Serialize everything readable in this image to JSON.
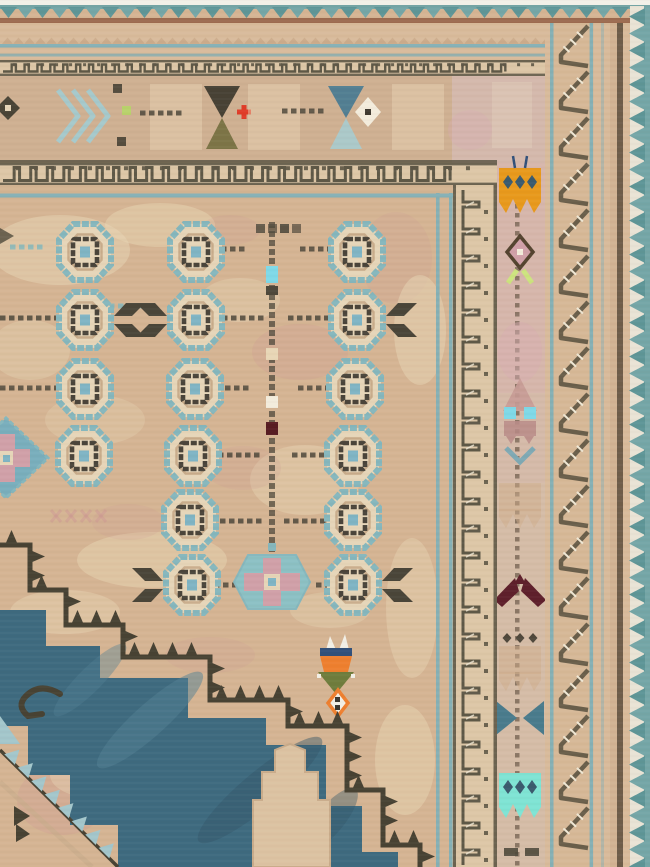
{
  "subject": "corner detail photograph of a vintage hand-knotted tribal rug",
  "palette": {
    "white_edge": "#f2f0e8",
    "teal_zig": "#74a6a7",
    "teal_zig_dark": "#5e9597",
    "red_line": "#9c6a4f",
    "outer_tan": "#d8bb9b",
    "outer_tan2": "#d2b393",
    "blue_line": "#85b0b5",
    "meander_bg": "#ddc7a7",
    "meander_dark": "#5e5847",
    "border_tan": "#cfb092",
    "corner_pink": "#d4b9ac",
    "field_tan": "#d5b493",
    "field_light": "#e8d6b6",
    "field_pink": "#cf9b94",
    "gul_blue": "#85b7bd",
    "gul_cream": "#e6d5b8",
    "gul_tan": "#c2a483",
    "gul_dark": "#4a443a",
    "gul_center": "#7fb4c4",
    "dash_dark": "#4e483b",
    "wing_dark": "#4a4539",
    "med_blue": "#3e6a7f",
    "med_blue_lt": "#517f93",
    "med_blue_dk": "#33576a",
    "med_dark": "#474233",
    "med_srr_blue": "#a3c6cb",
    "hex_blue": "#8cc0c4",
    "hex_pink": "#d0a0a8",
    "dia_blue": "#79aebc",
    "keyhole_tan": "#dcc2a2",
    "tulip_orange": "#ee7f2e",
    "tulip_navy": "#31507a",
    "tulip_green": "#6f7c3c",
    "tulip_white": "#f2efe6",
    "crown_orange": "#e8991c",
    "crown_turq": "#7fe4d4",
    "crown_dots_navy": "#3a5a6e",
    "maroon": "#5e1f2b",
    "deep_maroon": "#571c22",
    "cyan": "#7fd9e8",
    "leaf_green": "#cde37f",
    "moth_pink": "#c69b95",
    "moth_body": "#b98b87",
    "moth_legs": "#7ea9b4",
    "bowtie_teal": "#497b8c",
    "stripe_bg": "#d5bca7",
    "stripe_pink": "#d8adb2",
    "szig_dark": "#695e4a",
    "szig_bg": "#d6b897",
    "hatch_white": "#efe7d4",
    "dark_line": "#6e5c49",
    "olive": "#7c7446",
    "hour_dark": "#474134",
    "hour_blue": "#527e92",
    "hour_ltblue": "#abc9c9",
    "red_cross": "#e03c28",
    "lime": "#b7d46a",
    "white_diamond": "#f3ecdc",
    "faint_tan": "#cfae8c",
    "zig_edge_bg": "#e9e3d5",
    "weave_dark": "#6b5136",
    "weave_light": "#ffffff"
  },
  "abrash": [
    [
      60,
      250,
      70,
      35,
      "field_light",
      0.5
    ],
    [
      160,
      225,
      55,
      22,
      "field_light",
      0.45
    ],
    [
      300,
      352,
      48,
      28,
      "field_pink",
      0.28
    ],
    [
      396,
      258,
      36,
      46,
      "field_pink",
      0.2
    ],
    [
      420,
      330,
      26,
      55,
      "field_light",
      0.5
    ],
    [
      240,
      300,
      40,
      22,
      "field_light",
      0.35
    ],
    [
      305,
      480,
      55,
      35,
      "field_light",
      0.4
    ],
    [
      243,
      468,
      38,
      22,
      "field_pink",
      0.2
    ],
    [
      152,
      560,
      75,
      28,
      "field_light",
      0.45
    ],
    [
      65,
      612,
      55,
      22,
      "field_light",
      0.4
    ],
    [
      128,
      522,
      36,
      18,
      "field_pink",
      0.18
    ],
    [
      412,
      608,
      26,
      70,
      "field_light",
      0.4
    ],
    [
      405,
      760,
      30,
      55,
      "field_light",
      0.45
    ],
    [
      62,
      800,
      45,
      35,
      "field_pink",
      0.3
    ],
    [
      105,
      775,
      55,
      25,
      "field_light",
      0.4
    ],
    [
      210,
      655,
      45,
      18,
      "field_pink",
      0.2
    ],
    [
      330,
      610,
      40,
      18,
      "field_light",
      0.35
    ],
    [
      95,
      420,
      50,
      25,
      "field_light",
      0.3
    ],
    [
      30,
      350,
      40,
      30,
      "field_light",
      0.35
    ],
    [
      230,
      230,
      30,
      15,
      "field_pink",
      0.18
    ],
    [
      130,
      95,
      60,
      30,
      "field_light",
      0.35
    ],
    [
      300,
      120,
      55,
      30,
      "field_light",
      0.3
    ],
    [
      430,
      120,
      35,
      35,
      "field_pink",
      0.2
    ]
  ],
  "field": {
    "gul_rows": [
      {
        "y": 252,
        "guls": [
          {
            "x": 85
          },
          {
            "x": 196
          },
          {
            "x": 357
          }
        ]
      },
      {
        "y": 320,
        "guls": [
          {
            "x": 85,
            "wings": "right"
          },
          {
            "x": 196,
            "wings": "left"
          },
          {
            "x": 357,
            "wings": "right"
          }
        ]
      },
      {
        "y": 389,
        "guls": [
          {
            "x": 85
          },
          {
            "x": 195
          },
          {
            "x": 355
          }
        ]
      },
      {
        "y": 456,
        "guls": [
          {
            "x": 84
          },
          {
            "x": 193
          },
          {
            "x": 353
          }
        ]
      },
      {
        "y": 520,
        "guls": [
          {
            "x": 190
          },
          {
            "x": 353
          }
        ]
      },
      {
        "y": 585,
        "guls": [
          {
            "x": 192,
            "wings": "left"
          },
          {
            "x": 353,
            "wings": "right"
          }
        ]
      }
    ],
    "dash_rows": [
      {
        "y": 249,
        "segs": [
          [
            212,
            246
          ],
          [
            300,
            334
          ]
        ],
        "color": "dash_dark"
      },
      {
        "y": 247,
        "segs": [
          [
            10,
            44
          ]
        ],
        "color": "gul_blue"
      },
      {
        "y": 318,
        "segs": [
          [
            0,
            58
          ],
          [
            222,
            262
          ],
          [
            288,
            328
          ]
        ],
        "color": "dash_dark"
      },
      {
        "y": 306,
        "segs": [
          [
            64,
            142
          ]
        ],
        "color": "gul_blue"
      },
      {
        "y": 388,
        "segs": [
          [
            0,
            55
          ],
          [
            216,
            250
          ],
          [
            298,
            332
          ]
        ],
        "color": "dash_dark"
      },
      {
        "y": 455,
        "segs": [
          [
            218,
            260
          ],
          [
            292,
            328
          ]
        ],
        "color": "dash_dark"
      },
      {
        "y": 521,
        "segs": [
          [
            220,
            262
          ],
          [
            284,
            327
          ]
        ],
        "color": "dash_dark"
      },
      {
        "y": 585,
        "segs": [
          [
            214,
            234
          ],
          [
            316,
            336
          ]
        ],
        "color": "dash_dark"
      }
    ],
    "top_squares": {
      "x": 256,
      "y": 224,
      "n": 4,
      "colors": [
        "#5a5244",
        "#6b5e4e",
        "#4f483c",
        "#6b5e4e"
      ]
    },
    "dot_column": {
      "x": 272,
      "y1": 222,
      "y2": 562,
      "accents": [
        {
          "y": 266,
          "h": 17,
          "color": "cyan"
        },
        {
          "y": 286,
          "h": 9,
          "color": "dash_dark"
        },
        {
          "y": 348,
          "h": 12,
          "color": "field_light"
        },
        {
          "y": 396,
          "h": 12,
          "color": "white_diamond"
        },
        {
          "y": 422,
          "h": 13,
          "color": "deep_maroon"
        }
      ]
    },
    "pink_x_row": {
      "x": 56,
      "y": 516,
      "n": 4,
      "step": 15
    },
    "hex_medallion": {
      "cx": 272,
      "cy": 582
    },
    "diamond_medallion": {
      "cx": 6,
      "cy": 458
    },
    "tulip": {
      "cx": 336,
      "y": 637
    }
  },
  "medallion": {
    "serrated_outline": [
      [
        0,
        545
      ],
      [
        30,
        545
      ],
      [
        30,
        590
      ],
      [
        66,
        590
      ],
      [
        66,
        625
      ],
      [
        123,
        625
      ],
      [
        123,
        657
      ],
      [
        210,
        657
      ],
      [
        210,
        700
      ],
      [
        288,
        700
      ],
      [
        288,
        726
      ],
      [
        347,
        726
      ],
      [
        347,
        790
      ],
      [
        383,
        790
      ],
      [
        383,
        845
      ],
      [
        420,
        845
      ],
      [
        420,
        867
      ]
    ],
    "blue_outer": [
      [
        0,
        610
      ],
      [
        46,
        610
      ],
      [
        46,
        646
      ],
      [
        100,
        646
      ],
      [
        100,
        678
      ],
      [
        188,
        678
      ],
      [
        188,
        718
      ],
      [
        266,
        718
      ],
      [
        266,
        745
      ],
      [
        326,
        745
      ],
      [
        326,
        806
      ],
      [
        362,
        806
      ],
      [
        362,
        852
      ],
      [
        398,
        852
      ],
      [
        398,
        867
      ]
    ],
    "blue_inner": [
      [
        118,
        867
      ],
      [
        118,
        825
      ],
      [
        70,
        825
      ],
      [
        70,
        775
      ],
      [
        28,
        775
      ],
      [
        28,
        726
      ],
      [
        0,
        726
      ]
    ],
    "keyhole": [
      [
        253,
        867
      ],
      [
        253,
        800
      ],
      [
        262,
        800
      ],
      [
        262,
        772
      ],
      [
        275,
        772
      ],
      [
        275,
        750
      ],
      [
        290,
        744
      ],
      [
        305,
        750
      ],
      [
        305,
        772
      ],
      [
        318,
        772
      ],
      [
        318,
        800
      ],
      [
        330,
        800
      ],
      [
        330,
        867
      ]
    ],
    "srr_diag": {
      "x1": 0,
      "y1": 750,
      "x2": 118,
      "y2": 867,
      "teeth": 8
    },
    "streaks": [
      [
        150,
        720,
        70,
        16,
        -42,
        "med_blue_lt",
        0.5
      ],
      [
        260,
        790,
        80,
        18,
        -40,
        "med_blue_dk",
        0.45
      ],
      [
        90,
        680,
        50,
        12,
        -45,
        "med_blue_lt",
        0.4
      ],
      [
        330,
        820,
        40,
        14,
        -50,
        "med_blue_dk",
        0.4
      ]
    ]
  },
  "top_border": {
    "motifs": [
      {
        "type": "diamond",
        "x": 8,
        "y": 108
      },
      {
        "type": "chevrons",
        "x": 58,
        "y": 116
      },
      {
        "type": "sq",
        "x": 117,
        "y": 88,
        "color": "dash_dark"
      },
      {
        "type": "sq",
        "x": 121,
        "y": 141,
        "color": "dash_dark"
      },
      {
        "type": "sq",
        "x": 126,
        "y": 110,
        "color": "lime"
      },
      {
        "type": "washblock",
        "x": 150,
        "y": 84
      },
      {
        "type": "dashrow",
        "x": 140,
        "y": 113,
        "len": 38
      },
      {
        "type": "hourglass",
        "x": 222,
        "top": "hour_dark",
        "bottom": "olive"
      },
      {
        "type": "cross",
        "x": 244,
        "y": 112,
        "color": "red_cross"
      },
      {
        "type": "washblock",
        "x": 248,
        "y": 84
      },
      {
        "type": "dashrow",
        "x": 282,
        "y": 111,
        "len": 38
      },
      {
        "type": "hourglass",
        "x": 346,
        "top": "hour_blue",
        "bottom": "hour_ltblue"
      },
      {
        "type": "wdiamond",
        "x": 368,
        "y": 112
      },
      {
        "type": "washblock",
        "x": 392,
        "y": 84
      }
    ]
  },
  "right_border": {
    "stripe_motifs": [
      {
        "type": "crown",
        "y": 190,
        "color": "crown_orange",
        "dots": "crown_dots_navy",
        "antenna": true
      },
      {
        "type": "flower",
        "y": 252
      },
      {
        "type": "blush",
        "y": 352
      },
      {
        "type": "moth",
        "y": 420
      },
      {
        "type": "crown_faint",
        "y": 505
      },
      {
        "type": "arrowbird",
        "y": 598
      },
      {
        "type": "dotrow",
        "y": 638
      },
      {
        "type": "crown_faint",
        "y": 668
      },
      {
        "type": "bowtie",
        "y": 718
      },
      {
        "type": "crown",
        "y": 795,
        "color": "crown_turq",
        "dots": "crown_dots_navy",
        "antenna": false
      },
      {
        "type": "dashpair",
        "y": 852
      }
    ]
  }
}
